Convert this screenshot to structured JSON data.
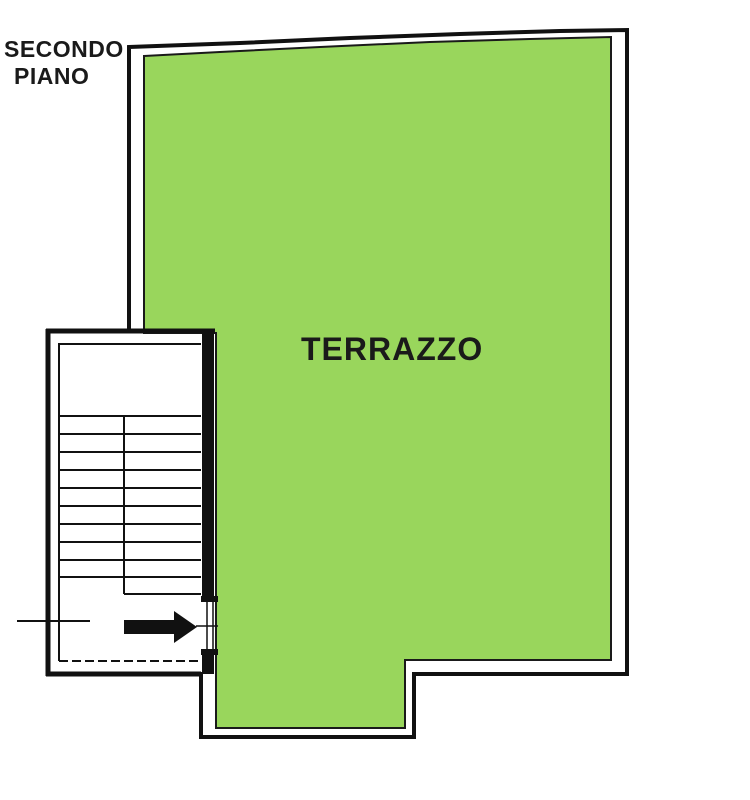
{
  "plan": {
    "floor_label": {
      "line1": "SECONDO",
      "line2": "PIANO"
    },
    "room_label": "TERRAZZO",
    "colors": {
      "terrace_fill": "#99d65c",
      "wall": "#111111",
      "background": "#ffffff"
    }
  }
}
